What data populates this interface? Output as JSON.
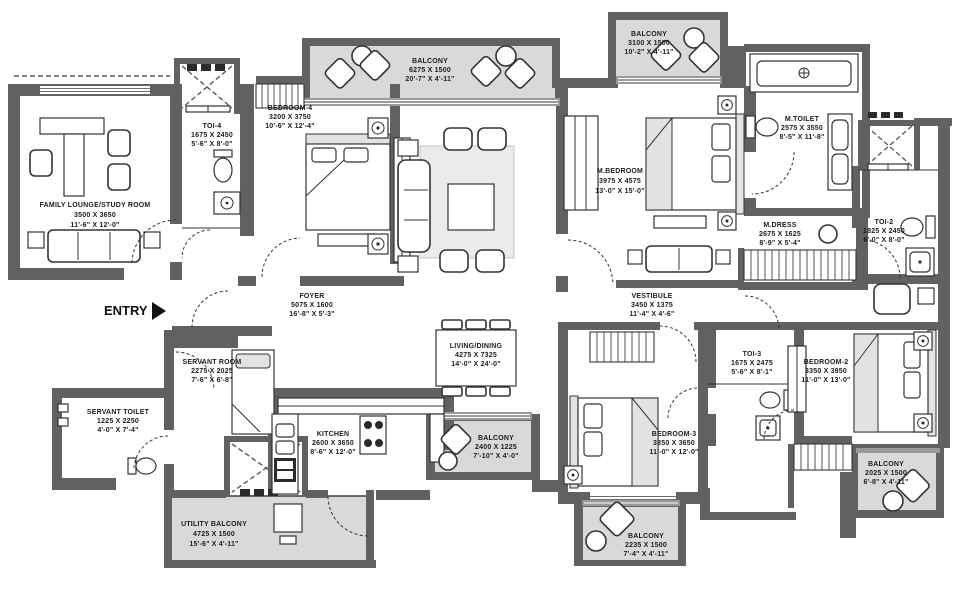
{
  "plan_title": "apartment-floor-plan",
  "colors": {
    "wall": "#616161",
    "balcony_fill": "#d9d9d9",
    "window_band": "#9a9a9a",
    "text": "#1c1c1c"
  },
  "entry": {
    "label": "ENTRY"
  },
  "rooms": {
    "family_lounge": {
      "name": "FAMILY LOUNGE/STUDY ROOM",
      "mm": "3500 X 3650",
      "ft": "11'-6\" X 12'-0\""
    },
    "toi4": {
      "name": "TOI-4",
      "mm": "1675 X 2450",
      "ft": "5'-6\" X 8'-0\""
    },
    "bedroom4": {
      "name": "BEDROOM-4",
      "mm": "3200 X 3750",
      "ft": "10'-6\" X 12'-4\""
    },
    "balcony_top": {
      "name": "BALCONY",
      "mm": "6275 X 1500",
      "ft": "20'-7\" X 4'-11\""
    },
    "balcony_top_right": {
      "name": "BALCONY",
      "mm": "3100 X 1500",
      "ft": "10'-2\" X 4'-11\""
    },
    "m_bedroom": {
      "name": "M.BEDROOM",
      "mm": "3975 X 4575",
      "ft": "13'-0\" X 15'-0\""
    },
    "m_toilet": {
      "name": "M.TOILET",
      "mm": "2575 X 3550",
      "ft": "8'-5\" X 11'-8\""
    },
    "m_dress": {
      "name": "M.DRESS",
      "mm": "2675 X 1625",
      "ft": "8'-9\" X 5'-4\""
    },
    "toi2": {
      "name": "TOI-2",
      "mm": "1825 X 2450",
      "ft": "6'-0\" X 8'-0\""
    },
    "foyer": {
      "name": "FOYER",
      "mm": "5075 X 1600",
      "ft": "16'-8\" X 5'-3\""
    },
    "vestibule": {
      "name": "VESTIBULE",
      "mm": "3450 X 1375",
      "ft": "11'-4\" X 4'-6\""
    },
    "living_dining": {
      "name": "LIVING/DINING",
      "mm": "4275 X 7325",
      "ft": "14'-0\" X 24'-0\""
    },
    "servant_room": {
      "name": "SERVANT ROOM",
      "mm": "2275 X 2025",
      "ft": "7'-6\" X 6'-8\""
    },
    "servant_toilet": {
      "name": "SERVANT TOILET",
      "mm": "1225 X 2250",
      "ft": "4'-0\" X 7'-4\""
    },
    "kitchen": {
      "name": "KITCHEN",
      "mm": "2600 X 3650",
      "ft": "8'-6\" X 12'-0\""
    },
    "utility_balcony": {
      "name": "UTILITY BALCONY",
      "mm": "4725 X 1500",
      "ft": "15'-6\" X 4'-11\""
    },
    "balcony_center": {
      "name": "BALCONY",
      "mm": "2400 X 1225",
      "ft": "7'-10\" X 4'-0\""
    },
    "bedroom3": {
      "name": "BEDROOM-3",
      "mm": "3350 X 3650",
      "ft": "11'-0\" X 12'-0\""
    },
    "toi3": {
      "name": "TOI-3",
      "mm": "1675 X 2475",
      "ft": "5'-6\" X 8'-1\""
    },
    "bedroom2": {
      "name": "BEDROOM-2",
      "mm": "3350 X 3950",
      "ft": "11'-0\" X 13'-0\""
    },
    "balcony_bottom": {
      "name": "BALCONY",
      "mm": "2235 X 1500",
      "ft": "7'-4\" X 4'-11\""
    },
    "balcony_right": {
      "name": "BALCONY",
      "mm": "2025 X 1500",
      "ft": "6'-8\" X 4'-11\""
    }
  }
}
